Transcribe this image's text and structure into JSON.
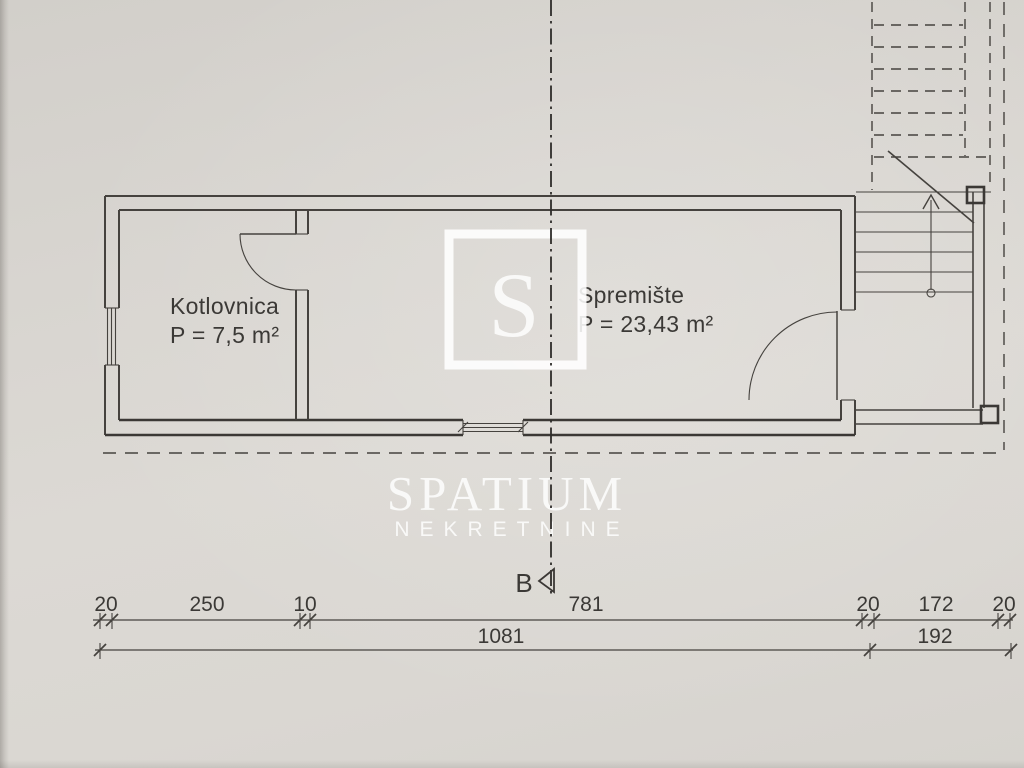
{
  "document": {
    "type": "floor-plan-photo"
  },
  "rooms": [
    {
      "name": "Kotlovnica",
      "area": "P = 7,5 m²"
    },
    {
      "name": "Spremište",
      "area": "P = 23,43 m²"
    }
  ],
  "watermark": {
    "letter": "S",
    "name": "SPATIUM",
    "subtitle": "NEKRETNINE"
  },
  "section": {
    "label": "B"
  },
  "dims": {
    "top": [
      "20",
      "250",
      "10",
      "781",
      "20",
      "172",
      "20"
    ],
    "bottom": [
      "1081",
      "192"
    ]
  },
  "colors": {
    "paper": "#d8d5d0",
    "ink": "#45423e",
    "section_line": "#2e2c2a",
    "watermark": "rgba(255,255,255,0.82)"
  }
}
